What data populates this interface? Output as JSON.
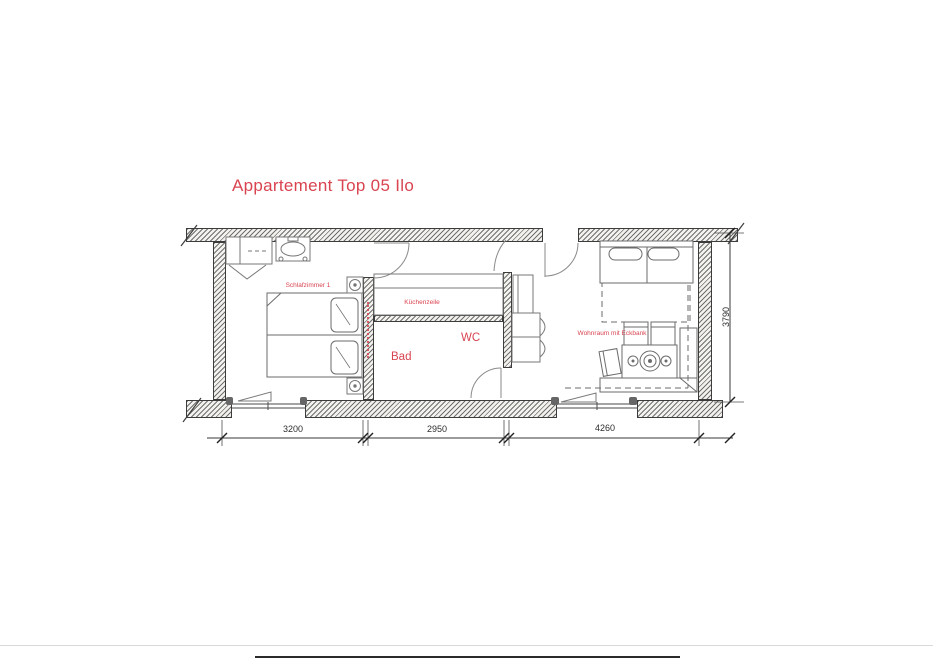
{
  "title": "Appartement Top 05 Ilo",
  "plan": {
    "rooms": {
      "bedroom_label": "Schlafzimmer 1",
      "kitchen_label": "Küchenzeile",
      "bath_label": "Bad",
      "wc_label": "WC",
      "living_label": "Wohnraum mit Eckbank"
    },
    "dimensions": {
      "bedroom_width": "3200",
      "middle_width": "2950",
      "living_width": "4260",
      "depth": "3790"
    }
  },
  "colors": {
    "label_red": "#d94450",
    "wall_hatch_gray": "#6f6f6f",
    "linework_gray": "#777777",
    "dimension_text": "#2e2e2e"
  }
}
